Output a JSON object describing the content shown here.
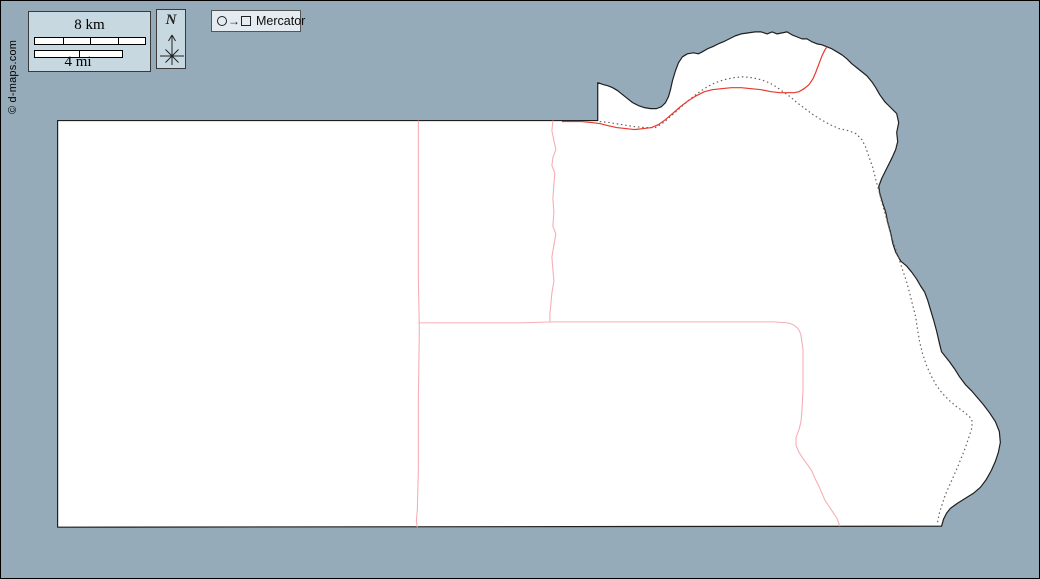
{
  "credit": "© d-maps.com",
  "scale_bar": {
    "km_label": "8 km",
    "mi_label": "4 mi",
    "km_segments": 4,
    "mi_segments": 2
  },
  "compass": {
    "label": "N"
  },
  "projection": {
    "arrow_symbol": "→",
    "label": "Mercator"
  },
  "colors": {
    "ocean": "#96abba",
    "land": "#ffffff",
    "coastline": "#1f1f1f",
    "road": "#e6392e",
    "boundary": "#f6aeb4",
    "trail": "#6f5f52",
    "panel_fill": "#c7d8e0",
    "legend_fill": "#e4ecf1",
    "frame": "#000000"
  }
}
